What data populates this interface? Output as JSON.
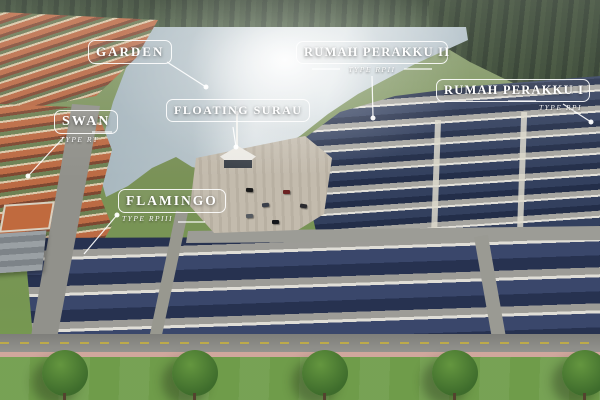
{
  "project_labels": {
    "garden": {
      "title": "GARDEN"
    },
    "swan": {
      "title": "SWAN",
      "subtype": "TYPE RT"
    },
    "floating_surau": {
      "title": "FLOATING SURAU"
    },
    "rumah_perakku_ii": {
      "title": "RUMAH PERAKKU II",
      "subtype": "TYPE RPII"
    },
    "rumah_perakku_i": {
      "title": "RUMAH PERAKKU I",
      "subtype": "TYPE RPI"
    },
    "flamingo": {
      "title": "FLAMINGO",
      "subtype": "TYPE RPIII"
    }
  },
  "colors": {
    "label_text": "#ffffff",
    "navy_roof": "#2b3650",
    "orange_roof": "#b96843",
    "lake_water": "#a9b9c2",
    "grass": "#6f9c4a",
    "forest": "#32432e",
    "road": "#9a9a96",
    "plaza": "#c3bbad",
    "sidewalk_pink": "#d0a79d"
  }
}
